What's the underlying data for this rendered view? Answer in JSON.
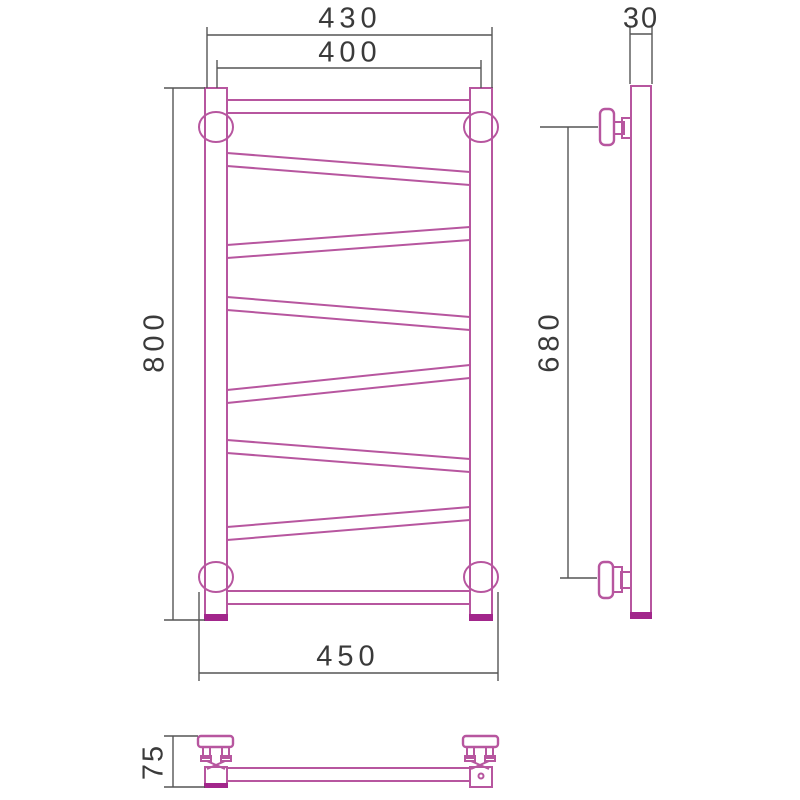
{
  "drawing": {
    "dimensions": {
      "front_outer_width": "430",
      "front_center_width": "400",
      "front_height": "800",
      "front_bracket_span": "450",
      "side_tube_width": "30",
      "side_bracket_spacing": "680",
      "bottom_wall_depth": "75"
    }
  },
  "colors": {
    "product_line": "#b7569f",
    "product_accent": "#a2268b",
    "dimension_line": "#555555",
    "dimension_text": "#3a3a3a",
    "background": "#ffffff"
  }
}
